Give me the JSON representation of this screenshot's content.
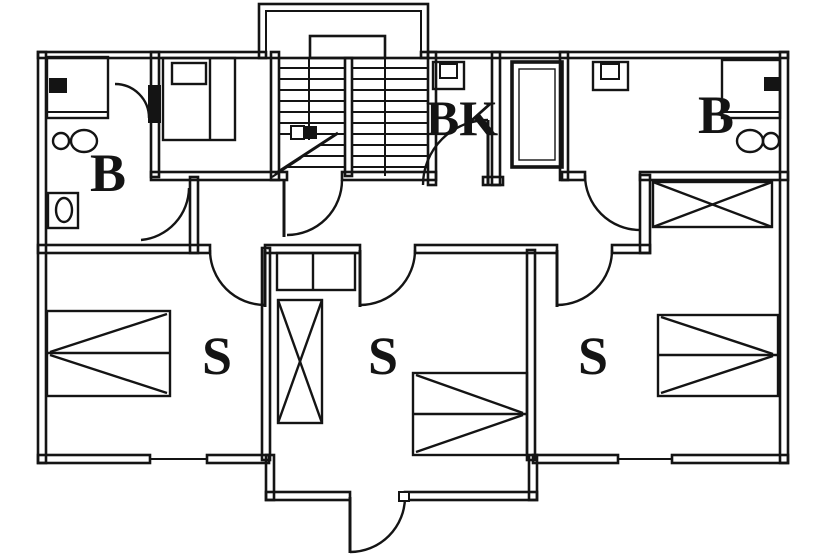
{
  "plan": {
    "background_color": "#ffffff",
    "line_color": "#141414",
    "labels": {
      "bath_left": "B",
      "bk_room": "BK",
      "bath_right": "B",
      "bedroom_left": "S",
      "bedroom_middle": "S",
      "bedroom_right": "S"
    },
    "fixtures": [
      "stairs",
      "shower-left",
      "toilet-left",
      "sink-left",
      "bed-top",
      "sink-bk",
      "shaft",
      "sink-right",
      "shower-right",
      "toilet-right",
      "wardrobe-right",
      "closet-middle",
      "wardrobe-middle",
      "bed-left",
      "bed-middle",
      "bed-right",
      "entrance-door",
      "window-left",
      "window-right"
    ]
  }
}
